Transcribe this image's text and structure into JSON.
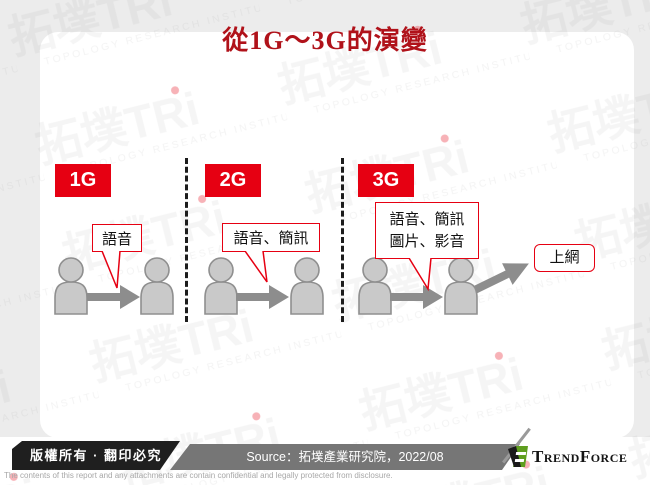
{
  "title": "從1G～3G的演變",
  "watermark": {
    "logo": "拓墣TRi",
    "subtitle": "TOPOLOGY RESEARCH INSTITUTE"
  },
  "sections": [
    {
      "label": "1G",
      "bubble": "語音"
    },
    {
      "label": "2G",
      "bubble": "語音、簡訊"
    },
    {
      "label": "3G",
      "bubble": "語音、簡訊",
      "bubble_line2": "圖片、影音"
    }
  ],
  "internet_label": "上網",
  "footer": {
    "copyright": "版權所有 · 翻印必究",
    "source": "Source：拓墣產業研究院，2022/08",
    "brand": "TrendForce",
    "disclaimer": "The contents of this report and any attachments are contain confidential and legally protected from disclosure."
  },
  "colors": {
    "accent_red": "#e60012",
    "title_red": "#b0121a",
    "figure_gray": "#c9c9c9",
    "arrow_gray": "#8d8d8d",
    "footer_black": "#1f1f1f",
    "footer_gray": "#767676",
    "brand_green": "#5f9e1f"
  }
}
